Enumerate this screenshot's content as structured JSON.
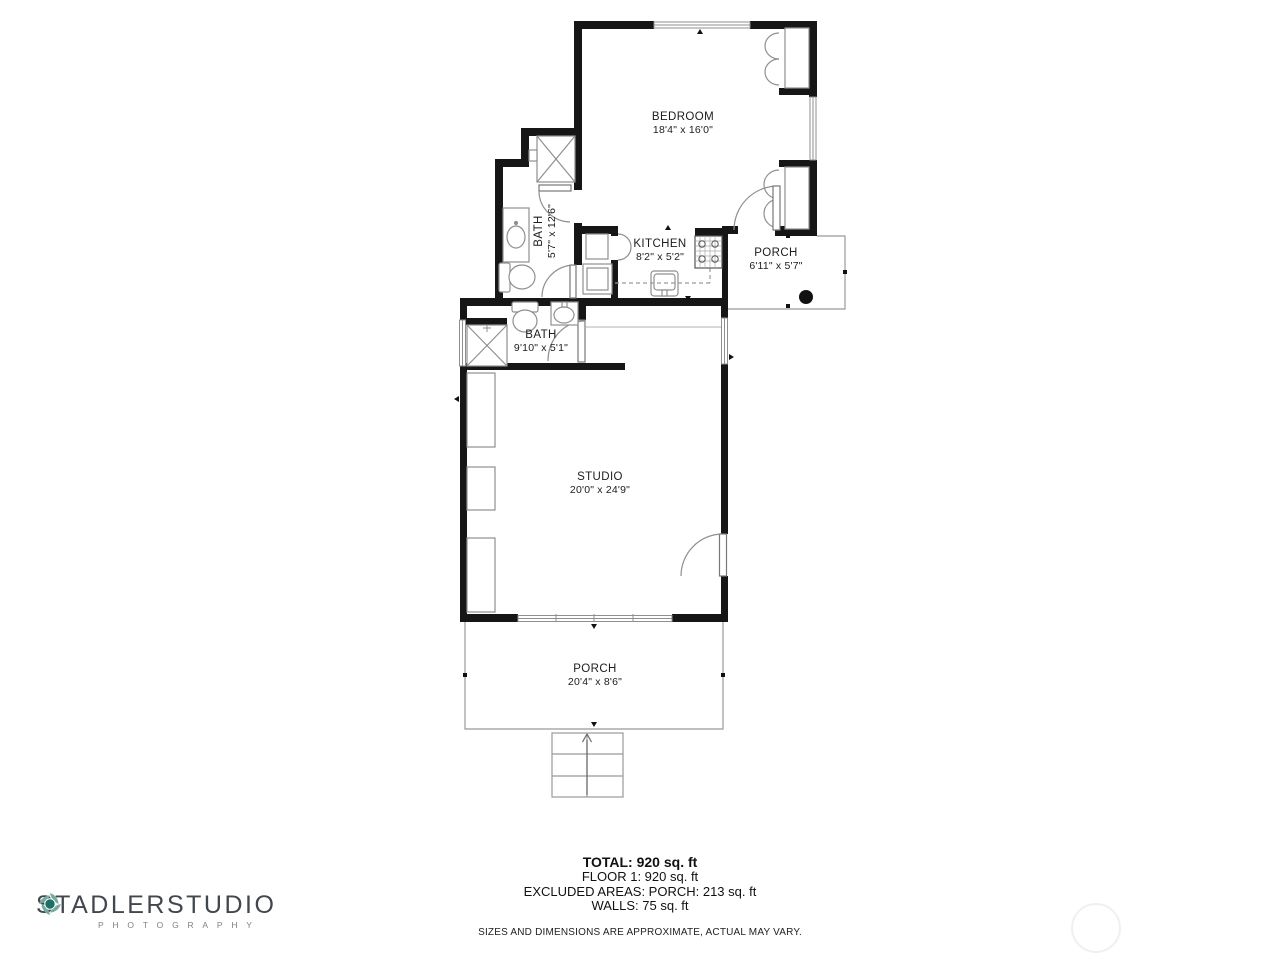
{
  "rooms": {
    "bedroom": {
      "name": "BEDROOM",
      "dims": "18'4\" x 16'0\""
    },
    "bath_upper": {
      "name": "BATH",
      "dims": "5'7\" x 12'6\""
    },
    "kitchen": {
      "name": "KITCHEN",
      "dims": "8'2\" x 5'2\""
    },
    "porch_side": {
      "name": "PORCH",
      "dims": "6'11\" x 5'7\""
    },
    "bath_lower": {
      "name": "BATH",
      "dims": "9'10\" x 5'1\""
    },
    "studio": {
      "name": "STUDIO",
      "dims": "20'0\" x 24'9\""
    },
    "porch_front": {
      "name": "PORCH",
      "dims": "20'4\" x 8'6\""
    }
  },
  "summary": {
    "total": "TOTAL: 920 sq. ft",
    "floor1": "FLOOR 1: 920 sq. ft",
    "excluded": "EXCLUDED AREAS: PORCH: 213 sq. ft",
    "walls": "WALLS: 75 sq. ft",
    "disclaimer": "SIZES AND DIMENSIONS ARE APPROXIMATE, ACTUAL MAY VARY."
  },
  "logo": {
    "word1": "STADLER",
    "word2": "STUDIO",
    "subtitle": "PHOTOGRAPHY",
    "icon": "camera-shutter-icon"
  },
  "colors": {
    "wall": "#161616",
    "thin_line": "#8f8f8f",
    "text": "#1c1c1c",
    "logo_text": "#42474d",
    "logo_accent": "#1e6f64",
    "watermark": "#f0f0f0"
  }
}
